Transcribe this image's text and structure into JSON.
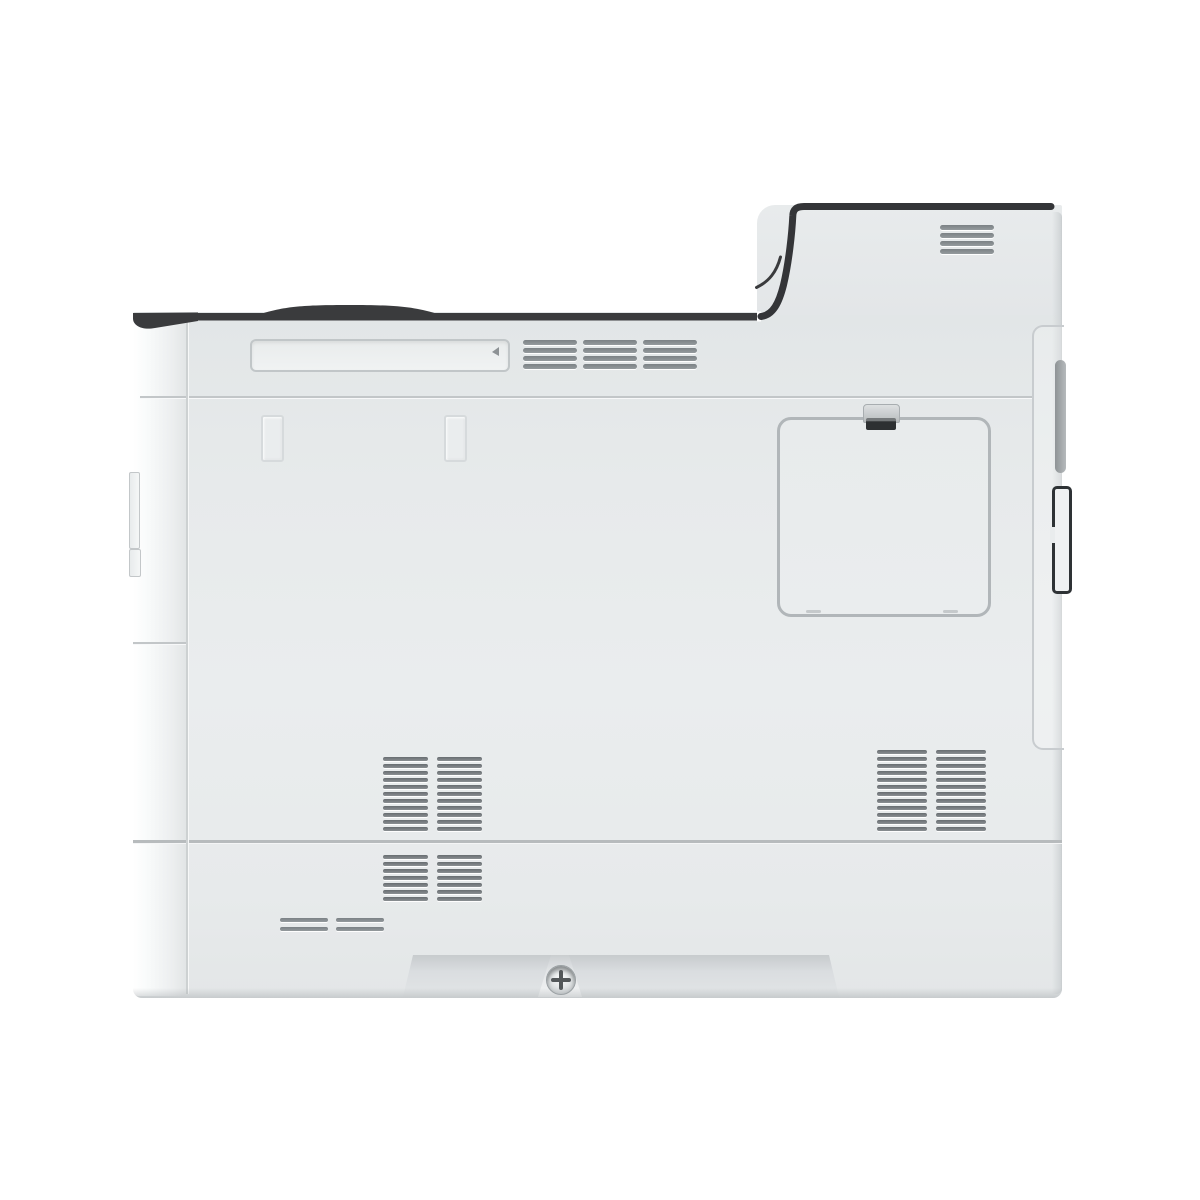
{
  "meta": {
    "type": "product-photo",
    "subject": "office laser printer, right-rear side view on white background",
    "background_color": "#ffffff"
  },
  "printer": {
    "colors": {
      "body": "#e7eaeb",
      "body_highlight": "#f8fafa",
      "dark_trim": "#3a3b3d",
      "seam": "#c2c6c8",
      "slat": "#7b8185",
      "panel_outline": "#b1b6b9",
      "port_outline": "#2e3235"
    },
    "parts": {
      "body": {
        "label": "printer side body panel"
      },
      "rear_top_cover": {
        "label": "raised rear top cover with exhaust vent"
      },
      "top_trim": {
        "label": "dark top edge trim with cover bump"
      },
      "handle_recess": {
        "label": "recessed carry handle"
      },
      "side_strip": {
        "label": "front edge strip with corner highlight"
      },
      "access_panel": {
        "label": "square rear access panel"
      },
      "latch": {
        "label": "access panel latch"
      },
      "right_interface_panel": {
        "label": "rear interface panel outline"
      },
      "interface_slot": {
        "label": "interface slot cover"
      },
      "rear_port": {
        "label": "rear connector port"
      },
      "mount_slots": {
        "label": "accessory mounting slots"
      },
      "left_tabs": {
        "label": "front cover hinge tabs"
      },
      "cassette_recess": {
        "label": "recessed base grip area"
      },
      "screw": {
        "label": "phillips screw head"
      }
    },
    "vents": {
      "top": {
        "cols": 3,
        "rows": 4,
        "col_w": 54,
        "col_gap": 6,
        "slat_h": 5,
        "row_gap": 3
      },
      "rear_exhaust": {
        "cols": 1,
        "rows": 4,
        "col_w": 54,
        "col_gap": 0,
        "slat_h": 5,
        "row_gap": 3
      },
      "mid_left_upper": {
        "cols": 2,
        "rows": 11,
        "col_w": 45,
        "col_gap": 9,
        "slat_h": 4,
        "row_gap": 3
      },
      "mid_left_lower": {
        "cols": 2,
        "rows": 7,
        "col_w": 45,
        "col_gap": 9,
        "slat_h": 4,
        "row_gap": 3
      },
      "mid_right": {
        "cols": 2,
        "rows": 12,
        "col_w": 50,
        "col_gap": 9,
        "slat_h": 4,
        "row_gap": 3
      },
      "small_pair": {
        "cols": 2,
        "rows": 2,
        "col_w": 48,
        "col_gap": 8,
        "slat_h": 4,
        "row_gap": 5
      }
    }
  }
}
